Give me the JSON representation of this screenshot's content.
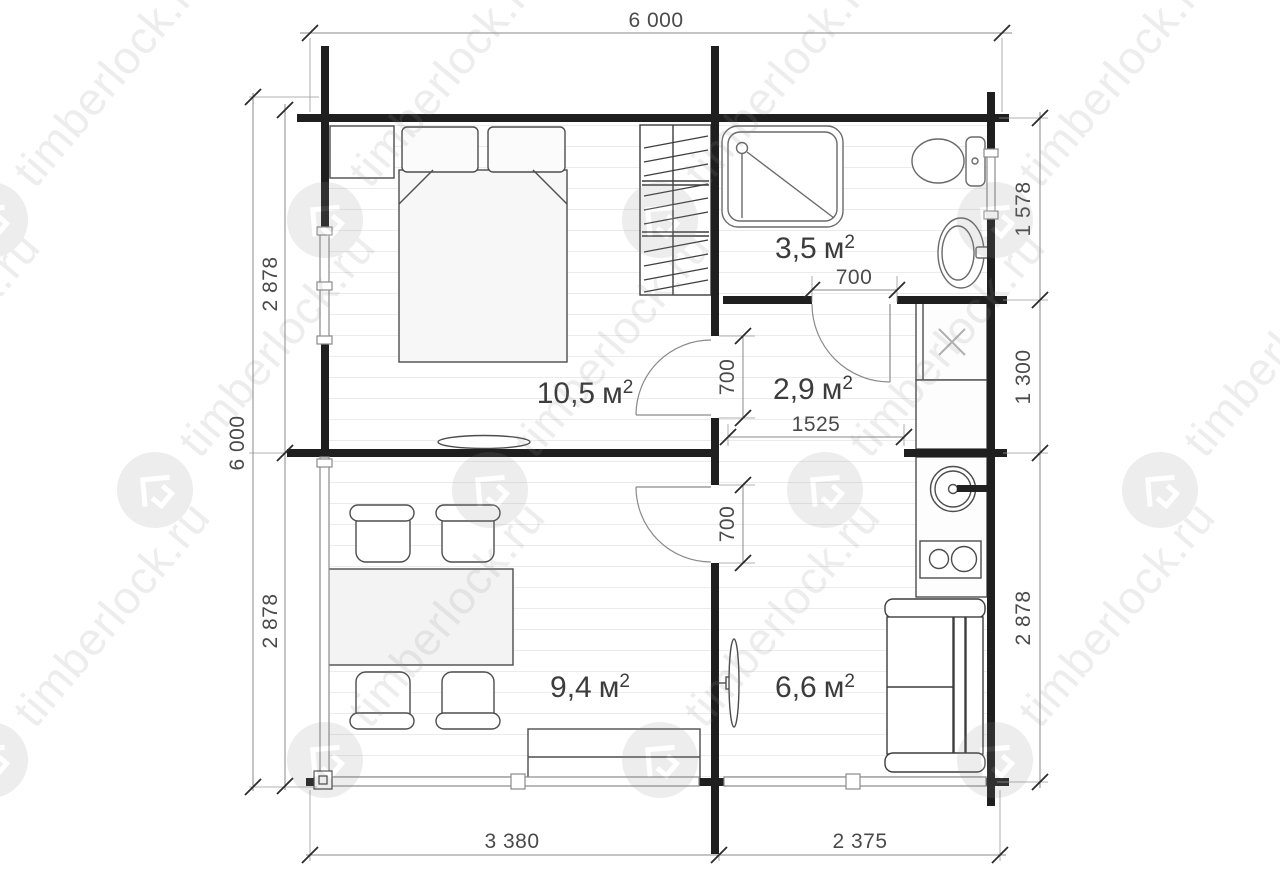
{
  "watermark": {
    "text": "timberlock.ru"
  },
  "units": {
    "unit": "м",
    "sup": "2"
  },
  "rooms": [
    {
      "id": "bedroom",
      "area": "10,5"
    },
    {
      "id": "bathroom",
      "area": "3,5"
    },
    {
      "id": "hallway",
      "area": "2,9"
    },
    {
      "id": "living-room",
      "area": "9,4"
    },
    {
      "id": "lounge",
      "area": "6,6"
    }
  ],
  "dims": {
    "top": "6 000",
    "left_total": "6 000",
    "left_upper": "2 878",
    "left_lower": "2 878",
    "right_top": "1 578",
    "right_mid": "1 300",
    "right_bottom": "2 878",
    "bottom_left": "3 380",
    "bottom_right": "2 375",
    "bedroom_door": "700",
    "bathroom_door": "700",
    "lounge_door": "700",
    "hall_opening": "1525"
  },
  "colors": {
    "wall": "#1f1f1f",
    "furniture_stroke": "#4d4d4d",
    "dim_line": "#8a8a8a",
    "watermark": "#8c8c8c"
  }
}
